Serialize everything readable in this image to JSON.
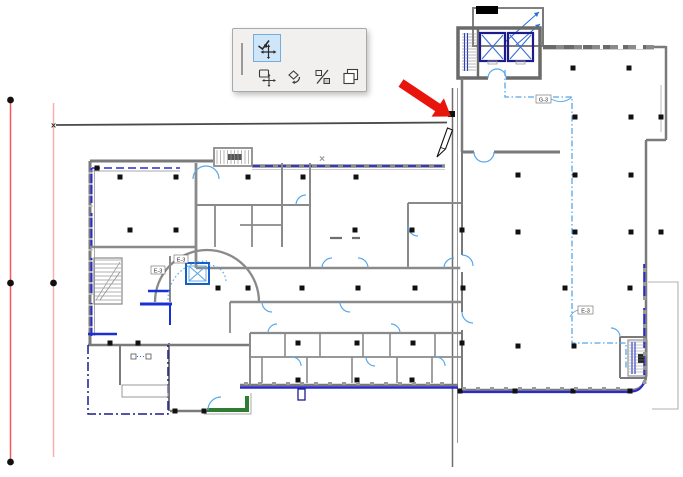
{
  "palette": {
    "background": "#f1f0ef",
    "selected_background": "#cfe6f8",
    "tools": [
      {
        "id": "drag-vertex",
        "icon": "drag-vertex-icon",
        "selected": true
      },
      {
        "id": "move",
        "icon": "move-icon",
        "selected": false
      },
      {
        "id": "rotate",
        "icon": "rotate-icon",
        "selected": false
      },
      {
        "id": "mirror",
        "icon": "mirror-icon",
        "selected": false
      },
      {
        "id": "multiply",
        "icon": "multiply-icon",
        "selected": false
      }
    ]
  },
  "plan": {
    "labels": {
      "route_top": "G-3",
      "route_right": "E-3",
      "room_left": "E-3",
      "elevator_left": "E-3"
    },
    "markers": {
      "endpoint_x": "×",
      "midpoint_x": "×"
    },
    "colors": {
      "wall_gray": "#7a7a7a",
      "window_blue": "#2a2ad0",
      "door_blue": "#5aa7e8",
      "route_blue": "#58a6e8",
      "layout_navy": "#1b1b8e",
      "balcony_green": "#2f7d32",
      "datum_red": "#f55a5a",
      "datum_pink": "#ffaaaa",
      "arrow_red": "#e8150c"
    },
    "cursor": "pencil"
  }
}
